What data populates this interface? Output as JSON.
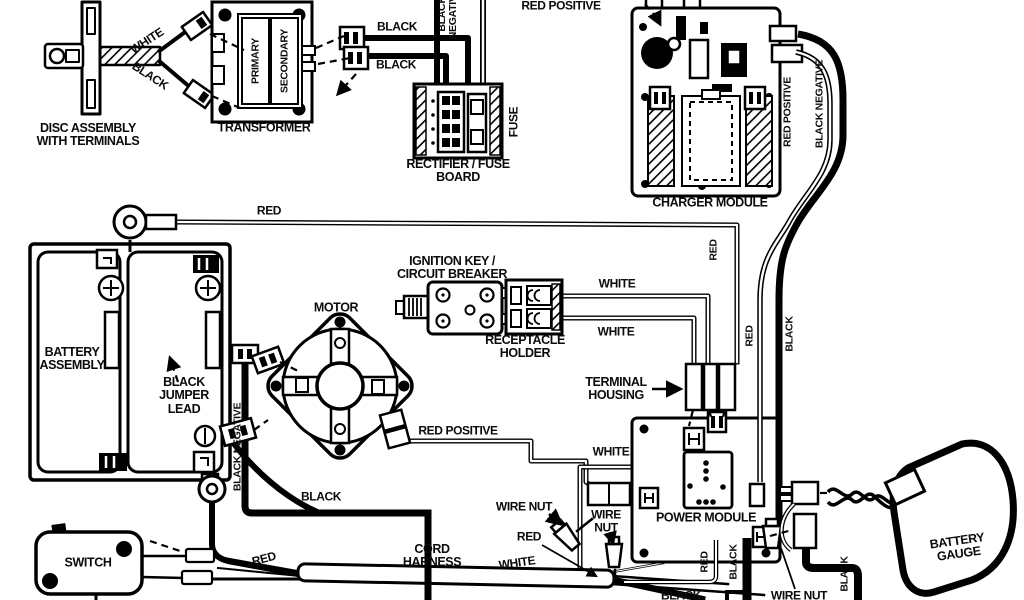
{
  "diagram_type": "electrical-wiring-diagram",
  "colors": {
    "background": "#ffffff",
    "ink": "#000000"
  },
  "labels": {
    "disc_assembly": "DISC ASSEMBLY\nWITH TERMINALS",
    "disc_wire_white": "WHITE",
    "disc_wire_black": "BLACK",
    "transformer": "TRANSFORMER",
    "transformer_primary": "PRIMARY",
    "transformer_secondary": "SECONDARY",
    "trans_wire_black_1": "BLACK",
    "trans_wire_black_2": "BLACK",
    "top_black_negative": "BLACK\nNEGATIVE",
    "top_red_positive": "RED POSITIVE",
    "fuse": "FUSE",
    "rectifier_fuse_board": "RECTIFIER / FUSE\nBOARD",
    "charger_module": "CHARGER MODULE",
    "charger_red_positive": "RED POSITIVE",
    "charger_black_negative": "BLACK NEGATIVE",
    "battery_red": "RED",
    "battery_assembly": "BATTERY\nASSEMBLY",
    "black_jumper_lead": "BLACK\nJUMPER\nLEAD",
    "battery_black_negative": "BLACK NEGATIVE",
    "motor": "MOTOR",
    "ignition_key": "IGNITION KEY /\nCIRCUIT BREAKER",
    "receptacle_holder": "RECEPTACLE\nHOLDER",
    "receptacle_white_1": "WHITE",
    "receptacle_white_2": "WHITE",
    "terminal_housing": "TERMINAL\nHOUSING",
    "housing_red": "RED",
    "right_red": "RED",
    "right_black": "BLACK",
    "motor_red_positive": "RED POSITIVE",
    "power_white": "WHITE",
    "power_module": "POWER MODULE",
    "wire_nut_left": "WIRE NUT",
    "wire_nut_center": "WIRE\nNUT",
    "harness_red_right": "RED",
    "harness_white": "WHITE",
    "switch": "SWITCH",
    "switch_red": "RED",
    "motor_black": "BLACK",
    "cord_harness": "CORD\nHARNESS",
    "power_red_bottom": "RED",
    "power_black_bottom": "BLACK",
    "bottom_black": "BLACK",
    "wire_nut_bottom": "WIRE NUT",
    "gauge_black": "BLACK",
    "battery_gauge": "BATTERY\nGAUGE"
  }
}
